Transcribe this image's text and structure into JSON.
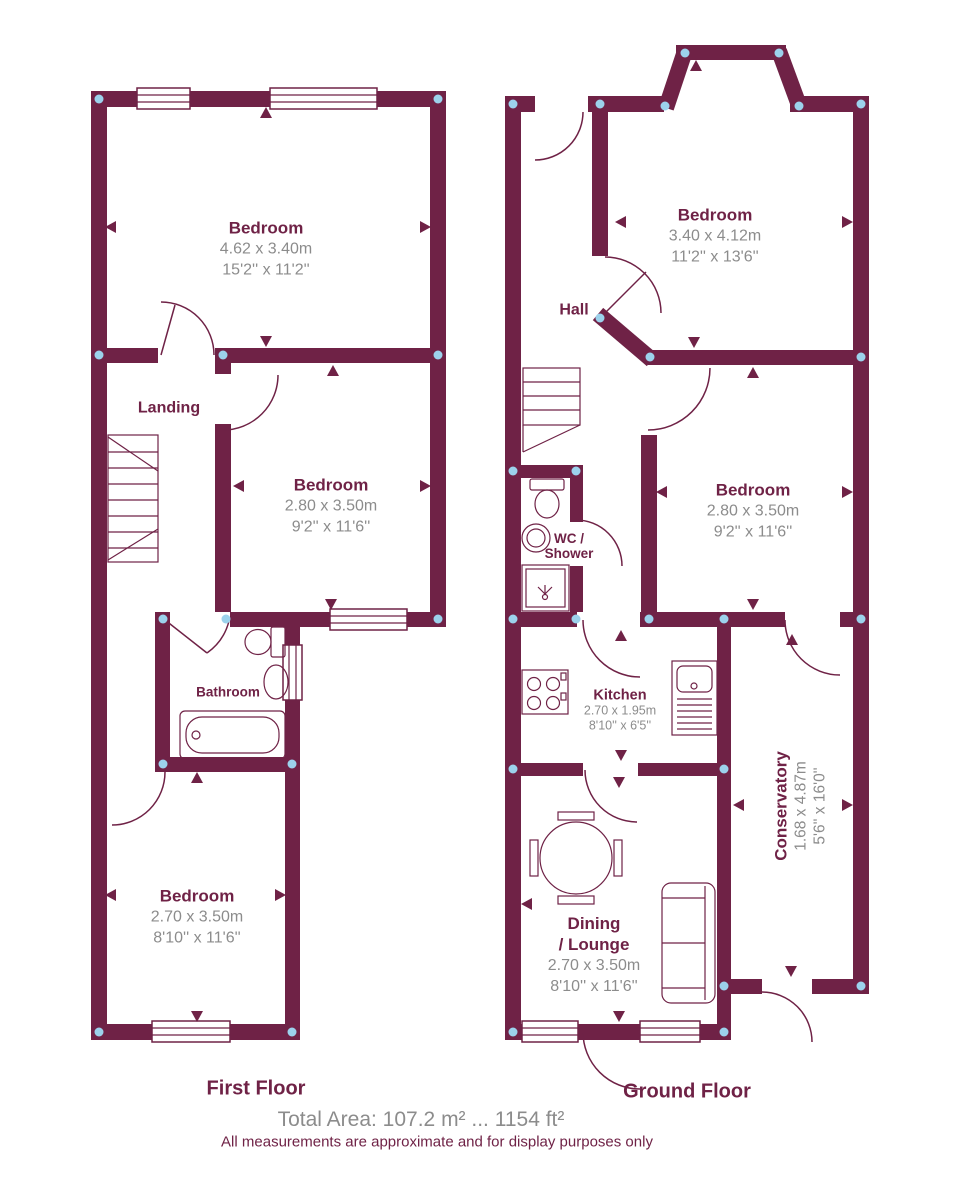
{
  "first_floor": {
    "title": "First Floor",
    "bedroom_front": {
      "name": "Bedroom",
      "metric": "4.62 x 3.40m",
      "imperial": "15'2'' x 11'2''"
    },
    "landing": {
      "name": "Landing"
    },
    "bedroom_middle": {
      "name": "Bedroom",
      "metric": "2.80 x 3.50m",
      "imperial": "9'2'' x 11'6''"
    },
    "bathroom": {
      "name": "Bathroom"
    },
    "bedroom_back": {
      "name": "Bedroom",
      "metric": "2.70 x 3.50m",
      "imperial": "8'10'' x 11'6''"
    }
  },
  "ground_floor": {
    "title": "Ground Floor",
    "bedroom_front": {
      "name": "Bedroom",
      "metric": "3.40 x 4.12m",
      "imperial": "11'2'' x 13'6''"
    },
    "hall": {
      "name": "Hall"
    },
    "bedroom_middle": {
      "name": "Bedroom",
      "metric": "2.80 x 3.50m",
      "imperial": "9'2'' x 11'6''"
    },
    "wc_shower": {
      "line1": "WC /",
      "line2": "Shower"
    },
    "kitchen": {
      "name": "Kitchen",
      "metric": "2.70 x 1.95m",
      "imperial": "8'10'' x 6'5''"
    },
    "conservatory": {
      "name": "Conservatory",
      "metric": "1.68 x 4.87m",
      "imperial": "5'6'' x 16'0''"
    },
    "dining_lounge": {
      "line1": "Dining",
      "line2": "/ Lounge",
      "metric": "2.70 x 3.50m",
      "imperial": "8'10'' x 11'6''"
    }
  },
  "footer": {
    "total_area": "Total Area: 107.2 m² ... 1154 ft²",
    "disclaimer": "All measurements are approximate and for display purposes only"
  },
  "colors": {
    "wall": "#6f2246",
    "dimension_text": "#8c8c8c",
    "corner_dot": "#9cd2ec"
  }
}
